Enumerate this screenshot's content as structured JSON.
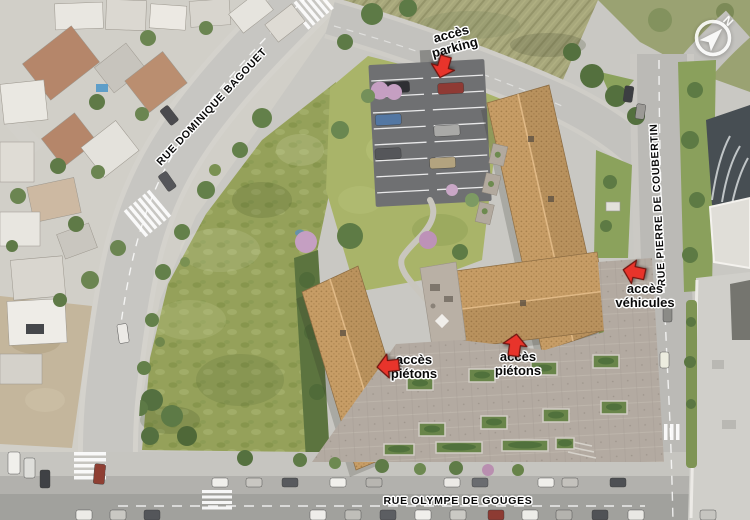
{
  "scene": {
    "description": "Aerial rendering of a residential development site with labeled streets and access points"
  },
  "compass": {
    "north_label": "N"
  },
  "street_labels": {
    "dominique_bagouet": "RUE DOMINIQUE BAGOUET",
    "pierre_de_coubertin": "RUE PIERRE DE COUBERTIN",
    "olympe_de_gouges": "RUE OLYMPE DE GOUGES"
  },
  "access_points": {
    "parking": {
      "line1": "accès",
      "line2": "parking",
      "arrow_direction": "down"
    },
    "vehicules": {
      "line1": "accès",
      "line2": "véhicules",
      "arrow_direction": "left"
    },
    "pietons_west": {
      "line1": "accès",
      "line2": "piétons",
      "arrow_direction": "left"
    },
    "pietons_east": {
      "line1": "accès",
      "line2": "piétons",
      "arrow_direction": "up"
    }
  },
  "colors": {
    "arrow_red": "#e8342b",
    "roof_terracotta": "#c79d66",
    "meadow_green": "#95a15a",
    "lawn_green": "#a9b469",
    "road_gray": "#c6c5c1",
    "parking_asphalt": "#6f7072",
    "plaza_gray": "#b3aaa1"
  }
}
